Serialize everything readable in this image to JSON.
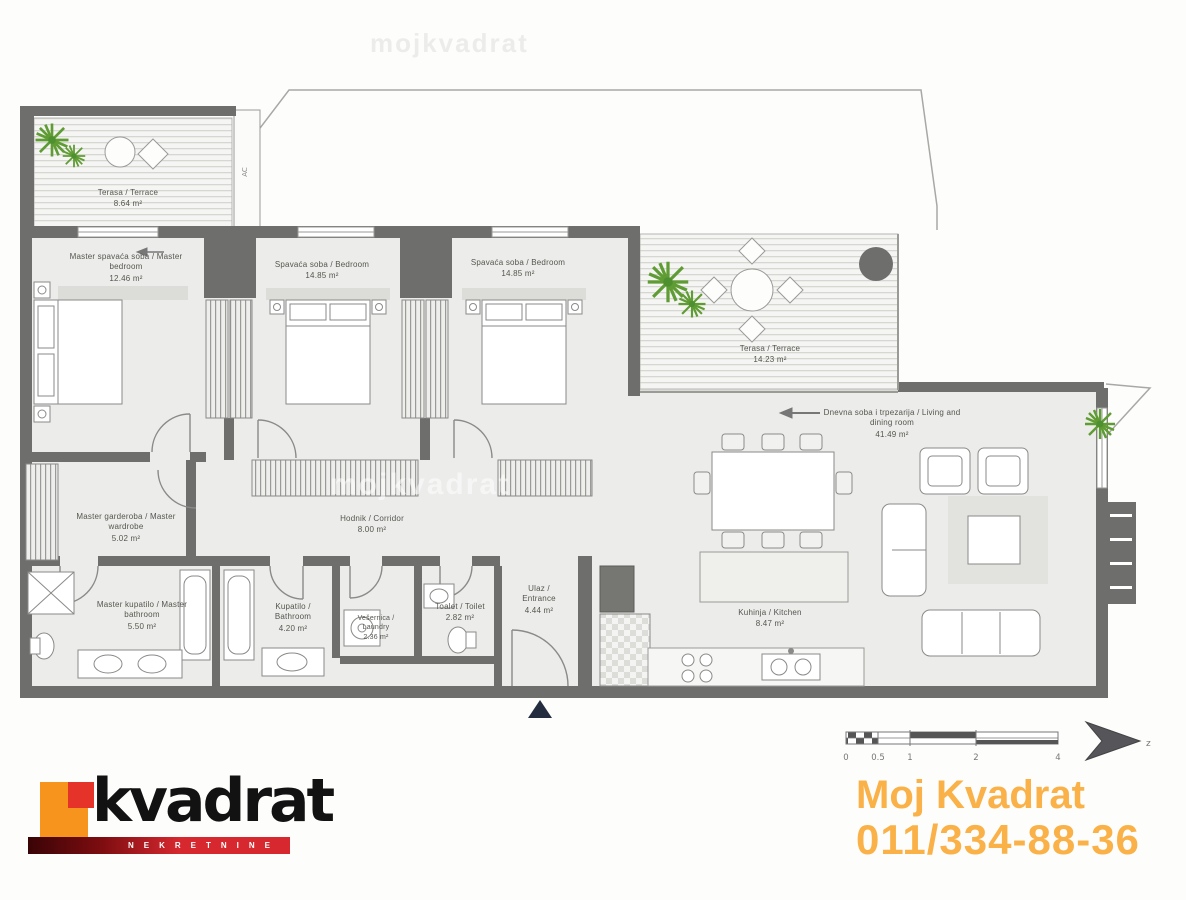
{
  "branding": {
    "logo_text": "kvadrat",
    "logo_tagline": "NEKRETNINE",
    "logo_orange": "#F7941D",
    "logo_red": "#D7282F",
    "contact_line1": "Moj Kvadrat",
    "contact_line2": "011/334-88-36",
    "contact_color": "#F9AC3B"
  },
  "watermark": {
    "text": "mojkvadrat"
  },
  "plan": {
    "ac_label": "AC",
    "north_label": "z",
    "scalebar": {
      "ticks": [
        "0",
        "0.5",
        "1",
        "2",
        "4"
      ]
    },
    "rooms": [
      {
        "id": "terrace-top",
        "name": "Terasa / Terrace",
        "area": "8.64 m²"
      },
      {
        "id": "master-bedroom",
        "name": "Master spavaća soba / Master bedroom",
        "area": "12.46 m²"
      },
      {
        "id": "bedroom-2",
        "name": "Spavaća soba / Bedroom",
        "area": "14.85 m²"
      },
      {
        "id": "bedroom-3",
        "name": "Spavaća soba / Bedroom",
        "area": "14.85 m²"
      },
      {
        "id": "terrace-middle",
        "name": "Terasa / Terrace",
        "area": "14.23 m²"
      },
      {
        "id": "living-dining",
        "name": "Dnevna soba i trpezarija / Living and dining room",
        "area": "41.49 m²"
      },
      {
        "id": "master-wardrobe",
        "name": "Master garderoba / Master wardrobe",
        "area": "5.02 m²"
      },
      {
        "id": "corridor",
        "name": "Hodnik / Corridor",
        "area": "8.00 m²"
      },
      {
        "id": "master-bathroom",
        "name": "Master kupatilo / Master bathroom",
        "area": "5.50 m²"
      },
      {
        "id": "bathroom",
        "name": "Kupatilo / Bathroom",
        "area": "4.20 m²"
      },
      {
        "id": "laundry",
        "name": "Vešernica / Laundry",
        "area": "2.36 m²"
      },
      {
        "id": "toilet",
        "name": "Toalet / Toilet",
        "area": "2.82 m²"
      },
      {
        "id": "entrance",
        "name": "Ulaz / Entrance",
        "area": "4.44 m²"
      },
      {
        "id": "kitchen",
        "name": "Kuhinja / Kitchen",
        "area": "8.47 m²"
      }
    ]
  }
}
